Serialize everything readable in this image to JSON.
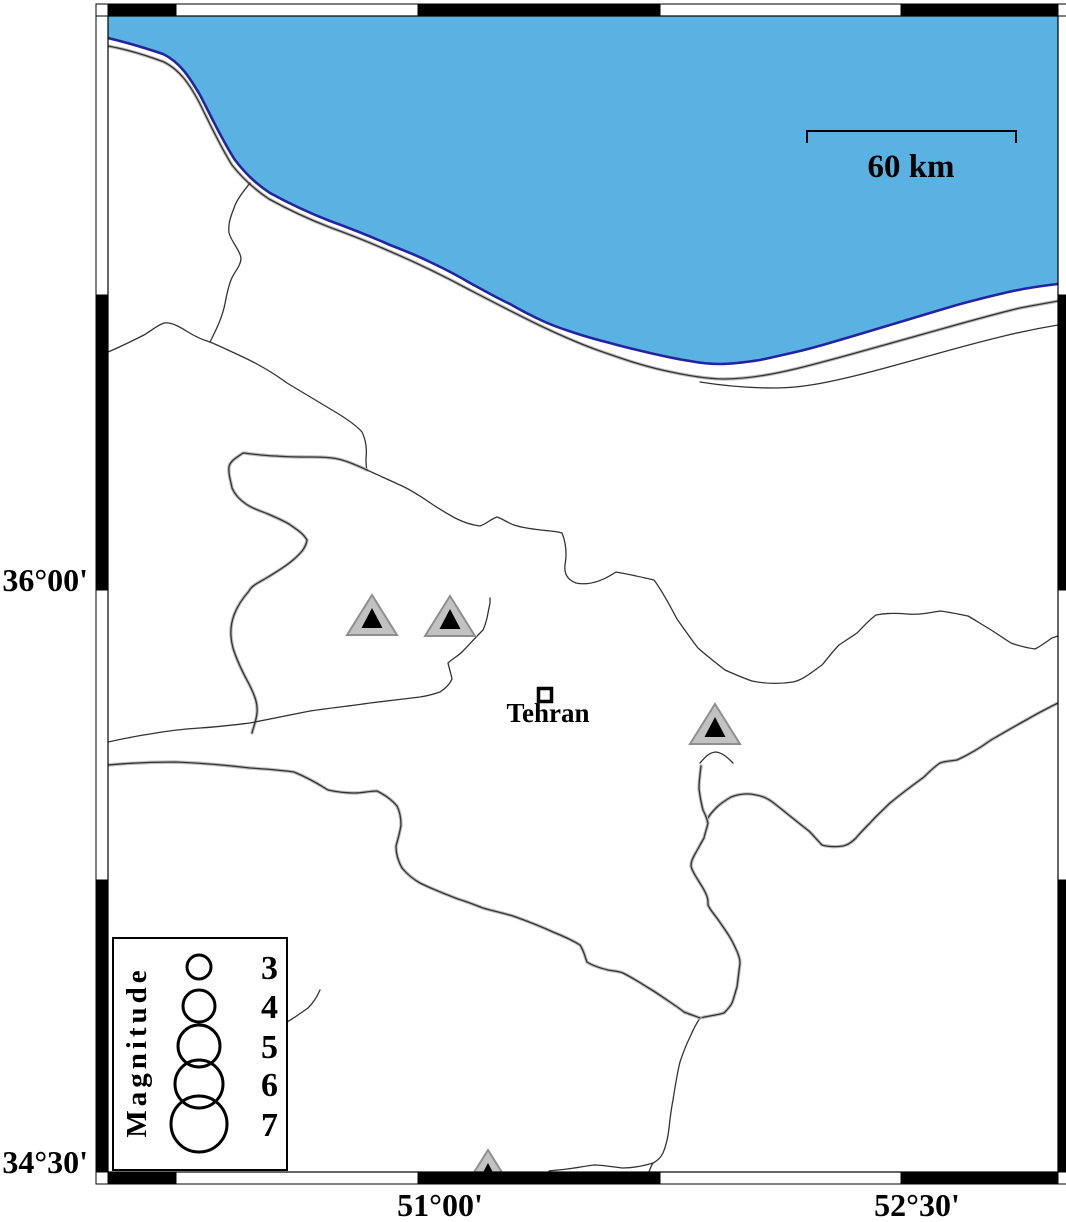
{
  "map": {
    "axis": {
      "left_labels": [
        "36°00'",
        "34°30'"
      ],
      "bottom_labels": [
        "51°00'",
        "52°30'"
      ]
    },
    "scale_bar": {
      "label": "60 km"
    },
    "city": {
      "name": "Tehran"
    },
    "legend": {
      "title": "Magnitude",
      "entries": [
        {
          "magnitude": "3",
          "radius": 12
        },
        {
          "magnitude": "4",
          "radius": 16
        },
        {
          "magnitude": "5",
          "radius": 21
        },
        {
          "magnitude": "6",
          "radius": 24
        },
        {
          "magnitude": "7",
          "radius": 28
        }
      ]
    },
    "colors": {
      "sea": "#5AB2E2",
      "coastline": "#2424A0",
      "border": "#333333",
      "border_shadow": "#bdbdbd",
      "triangle_fill": "#c2c2c2",
      "triangle_edge": "#8f8f8f",
      "triangle_inner": "#000000"
    },
    "markers": [
      {
        "x": 372,
        "y": 619
      },
      {
        "x": 450,
        "y": 620
      },
      {
        "x": 715,
        "y": 728
      },
      {
        "x": 488,
        "y": 1174
      }
    ]
  }
}
